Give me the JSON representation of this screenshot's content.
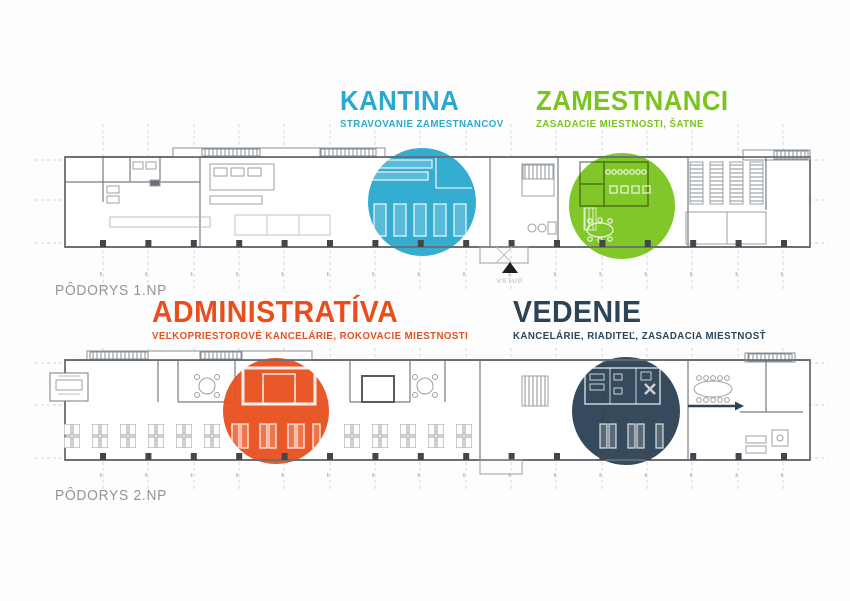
{
  "poster": {
    "floors": [
      {
        "label": "PÔDORYS 1.NP",
        "entrance": "VSTUP",
        "zones": [
          {
            "title": "KANTINA",
            "subtitle": "STRAVOVANIE ZAMESTNANCOV",
            "color": "#2aa9cf"
          },
          {
            "title": "ZAMESTNANCI",
            "subtitle": "ZASADACIE MIESTNOSTI, ŠATNE",
            "color": "#7bc41e"
          }
        ]
      },
      {
        "label": "PÔDORYS 2.NP",
        "zones": [
          {
            "title": "ADMINISTRATÍVA",
            "subtitle": "VEĽKOPRIESTOROVÉ KANCELÁRIE, ROKOVACIE MIESTNOSTI",
            "color": "#e84f1d"
          },
          {
            "title": "VEDENIE",
            "subtitle": "KANCELÁRIE, RIADITEĽ, ZASADACIA MIESTNOSŤ",
            "color": "#2d4356"
          }
        ]
      }
    ],
    "plan_colors": {
      "wall": "#676d73",
      "furniture": "#9aa0a5",
      "grid": "#d2d5d8",
      "column": "#41474c"
    }
  }
}
